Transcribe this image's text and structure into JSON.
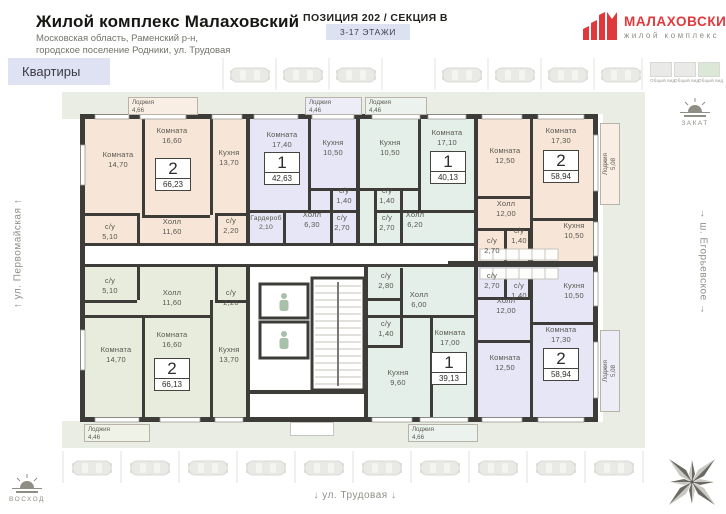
{
  "header": {
    "project_title": "Жилой комплекс Малаховский",
    "address_line1": "Московская область, Раменский р-н,",
    "address_line2": "городское поселение Родники, ул. Трудовая",
    "position_title": "ПОЗИЦИЯ 202 / СЕКЦИЯ В",
    "floors_badge": "3-17 ЭТАЖИ",
    "brand": {
      "name": "МАЛАХОВСКИЙ",
      "subtitle": "жилой комплекс",
      "color": "#e0393c"
    }
  },
  "nav": {
    "apartments_label": "Квартиры"
  },
  "section_thumbnails": [
    {
      "label": "Общий вид",
      "selected": false
    },
    {
      "label": "Общий вид",
      "selected": false
    },
    {
      "label": "Общий вид",
      "selected": true
    }
  ],
  "environment": {
    "street_left": "↑ ул. Первомайская ↑",
    "street_bottom": "↓ ул. Трудовая ↓",
    "street_right": "→ ш. Егорьевское →",
    "sunset_label": "ЗАКАТ",
    "sunrise_label": "ВОСХОД"
  },
  "plan": {
    "colors": {
      "wall": "#3d3c38",
      "peach": "#f7e6d7",
      "lavender": "#e6e6f6",
      "mint": "#e4efe9",
      "sage": "#e7ecdc",
      "site": "#e9ede3"
    },
    "apartments": [
      {
        "rooms_count": "2",
        "total_area": "66,23",
        "rooms": [
          {
            "name": "Комната",
            "area": "14,70"
          },
          {
            "name": "Комната",
            "area": "16,60"
          },
          {
            "name": "Кухня",
            "area": "13,70"
          },
          {
            "name": "Холл",
            "area": "11,60"
          },
          {
            "name": "с/у",
            "area": "5,10"
          },
          {
            "name": "с/у",
            "area": "2,20"
          }
        ]
      },
      {
        "rooms_count": "1",
        "total_area": "42,63",
        "rooms": [
          {
            "name": "Комната",
            "area": "17,40"
          },
          {
            "name": "Кухня",
            "area": "10,50"
          },
          {
            "name": "Холл",
            "area": "6,30"
          },
          {
            "name": "Гардероб",
            "area": "2,10"
          },
          {
            "name": "с/у",
            "area": "1,40"
          },
          {
            "name": "с/у",
            "area": "2,70"
          }
        ]
      },
      {
        "rooms_count": "1",
        "total_area": "40,13",
        "rooms": [
          {
            "name": "Комната",
            "area": "17,10"
          },
          {
            "name": "Кухня",
            "area": "10,50"
          },
          {
            "name": "Холл",
            "area": "6,20"
          },
          {
            "name": "с/у",
            "area": "1,40"
          },
          {
            "name": "с/у",
            "area": "2,70"
          }
        ]
      },
      {
        "rooms_count": "2",
        "total_area": "58,94",
        "rooms": [
          {
            "name": "Комната",
            "area": "12,50"
          },
          {
            "name": "Комната",
            "area": "17,30"
          },
          {
            "name": "Холл",
            "area": "12,00"
          },
          {
            "name": "Кухня",
            "area": "10,50"
          },
          {
            "name": "с/у",
            "area": "2,70"
          },
          {
            "name": "с/у",
            "area": "1,40"
          }
        ]
      },
      {
        "rooms_count": "2",
        "total_area": "58,94",
        "rooms": [
          {
            "name": "Кухня",
            "area": "10,50"
          },
          {
            "name": "Холл",
            "area": "12,00"
          },
          {
            "name": "Комната",
            "area": "17,30"
          },
          {
            "name": "Комната",
            "area": "12,50"
          },
          {
            "name": "с/у",
            "area": "2,70"
          },
          {
            "name": "с/у",
            "area": "1,40"
          }
        ]
      },
      {
        "rooms_count": "1",
        "total_area": "39,13",
        "rooms": [
          {
            "name": "Холл",
            "area": "6,00"
          },
          {
            "name": "с/у",
            "area": "2,80"
          },
          {
            "name": "с/у",
            "area": "1,40"
          },
          {
            "name": "Кухня",
            "area": "9,60"
          },
          {
            "name": "Комната",
            "area": "17,00"
          }
        ]
      },
      {
        "rooms_count": "2",
        "total_area": "66,13",
        "rooms": [
          {
            "name": "с/у",
            "area": "5,10"
          },
          {
            "name": "Холл",
            "area": "11,60"
          },
          {
            "name": "с/у",
            "area": "2,20"
          },
          {
            "name": "Комната",
            "area": "14,70"
          },
          {
            "name": "Комната",
            "area": "16,60"
          },
          {
            "name": "Кухня",
            "area": "13,70"
          }
        ]
      }
    ],
    "loggias": [
      {
        "name": "Лоджия",
        "area": "4,66"
      },
      {
        "name": "Лоджия",
        "area": "4,46"
      },
      {
        "name": "Лоджия",
        "area": "4,46"
      },
      {
        "name": "Лоджия",
        "area": "5,08"
      },
      {
        "name": "Лоджия",
        "area": "5,08"
      },
      {
        "name": "Лоджия",
        "area": "4,46"
      },
      {
        "name": "Лоджия",
        "area": "4,66"
      }
    ]
  }
}
